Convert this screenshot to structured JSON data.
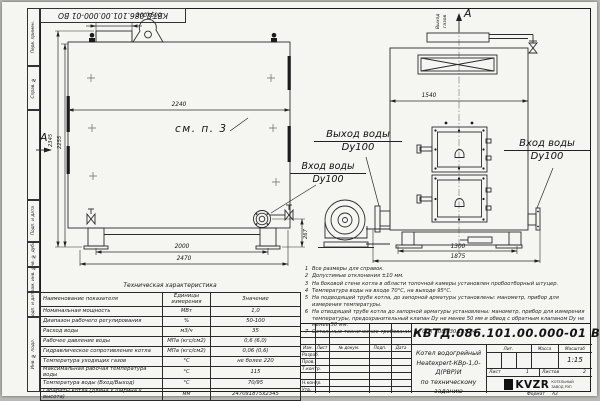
{
  "title_block": {
    "doc_number": "КВТД.086.101.00.000-01 ВО",
    "product_title_line1": "Котел водогрейный",
    "product_title_line2": "Heatexpert-КВр-1,0-Д(РВР)И",
    "product_title_line3": "по техническому заданию",
    "header_cols": {
      "izm": "Изм.",
      "list": "Лист",
      "doc": "№ докум.",
      "sign": "Подп.",
      "date": "Дата"
    },
    "roles": {
      "r0": "Разраб.",
      "r1": "Пров.",
      "r2": "Т.контр.",
      "r4": "Н.контр.",
      "r5": "Утв."
    },
    "lit_label": "Лит.",
    "mass_label": "Масса",
    "scale_label": "Масштаб",
    "scale_value": "1:15",
    "sheet_label": "Лист",
    "sheet_number": "1",
    "sheets_label": "Листов",
    "sheets_total": "2",
    "company": {
      "logo": "KVZR",
      "line1": "КОТЕЛЬНЫЙ",
      "line2": "ЗАВОД РЭП"
    },
    "format_label": "Формат",
    "format_value": "А3"
  },
  "margin_labels": [
    "Перв. примен.",
    "Справ. №",
    "Подп. и дата",
    "Инв. № дубл.",
    "Взам. инв. №",
    "Подп. и дата",
    "Инв. № подл."
  ],
  "dims": {
    "duct": "300x600",
    "body_width": "2240",
    "height_total": "2345",
    "height_body": "2255",
    "base_span_side": "2000",
    "length_total": "2470",
    "port_height": "267",
    "front_width": "1540",
    "front_base": "1300",
    "front_total": "1875"
  },
  "annotations": {
    "see_note": "см. п. 3",
    "section_a_left": "А",
    "view_a_top": "А",
    "gas_out_word1": "Выход",
    "gas_out_word2": "газов",
    "water_out_line1": "Выход воды",
    "water_out_line2": "Dy100",
    "water_in_side_line1": "Вход воды",
    "water_in_side_line2": "Dy100",
    "water_in_front_line1": "Вход воды",
    "water_in_front_line2": "Dy100"
  },
  "notes": [
    {
      "num": "1",
      "text": "Все размеры для справок."
    },
    {
      "num": "2",
      "text": "Допустимые отклонения ±10 мм."
    },
    {
      "num": "3",
      "text": "На боковой стене котла в области топочной камеры установлен пробоотборный штуцер."
    },
    {
      "num": "4",
      "text": "Температура воды на входе 70°С, на выходе 95°С."
    },
    {
      "num": "5",
      "text": "На подводящей трубе котла, до запорной арматуры установлены: манометр, прибор для измерения температуры."
    },
    {
      "num": "6",
      "text": "На отводящей трубе котла до запорной арматуры установлены: манометр, прибор для измерения температуры, предохранительный клапан Dу не менее 50 мм и обвод с обратным клапаном Dу не менее 50 мм."
    },
    {
      "num": "7",
      "text": "Остальные технические требования по ОСТ 108.030.135-84."
    }
  ],
  "spec_table": {
    "title": "Техническая характеристика",
    "headers": {
      "name": "Наименование показателя",
      "units": "Единицы измерения",
      "value": "Значение"
    },
    "rows": [
      {
        "name": "Номинальная мощность",
        "units": "МВт",
        "value": "1,0"
      },
      {
        "name": "Диапазон рабочего регулирования",
        "units": "%",
        "value": "50-100"
      },
      {
        "name": "Расход воды",
        "units": "м3/ч",
        "value": "35"
      },
      {
        "name": "Рабочее давление воды",
        "units": "МПа (кгс/см2)",
        "value": "0,6 (6,0)"
      },
      {
        "name": "Гидравлическое сопротивление котла",
        "units": "МПа (кгс/см2)",
        "value": "0,06 (0,6)"
      },
      {
        "name": "Температура уходящих газов",
        "units": "°С",
        "value": "не более 220"
      },
      {
        "name": "Максимальная рабочая температура воды",
        "units": "°С",
        "value": "115"
      },
      {
        "name": "Температура воды (Вход/Выход)",
        "units": "°С",
        "value": "70/95"
      },
      {
        "name": "Габариты котла (длина х ширина х высота)",
        "units": "мм",
        "value": "2470х1875х2345"
      }
    ]
  }
}
